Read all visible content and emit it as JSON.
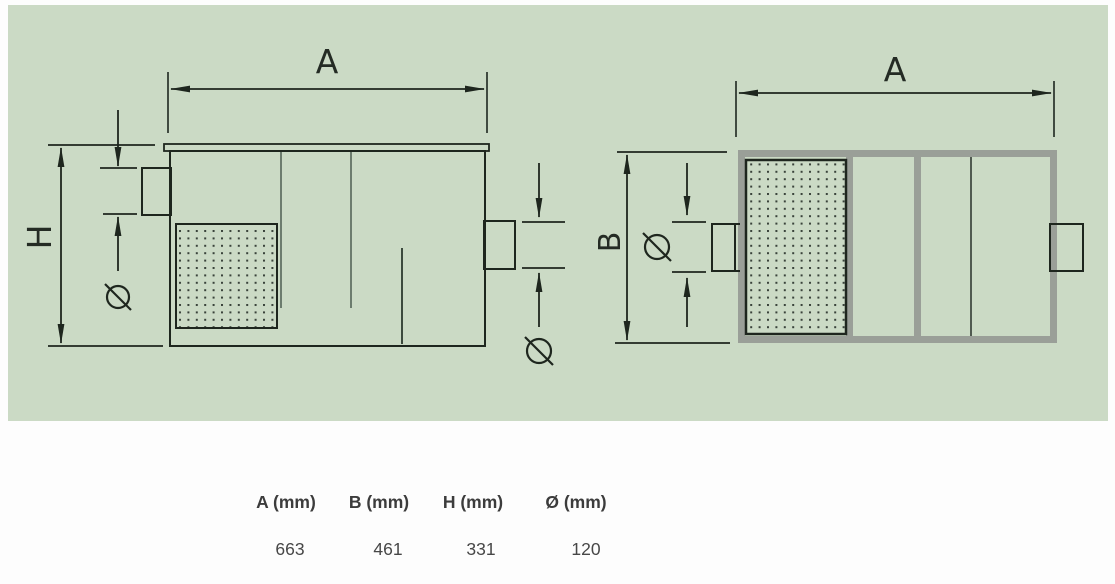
{
  "side_view": {
    "width_label": "A",
    "height_label": "H",
    "inlet_diameter_symbol": "Ø",
    "outlet_diameter_symbol": "Ø"
  },
  "top_view": {
    "width_label": "A",
    "depth_label": "B",
    "inlet_diameter_symbol": "Ø"
  },
  "dimensions_table": {
    "columns": [
      "A (mm)",
      "B (mm)",
      "H (mm)",
      "Ø (mm)"
    ],
    "values": [
      "663",
      "461",
      "331",
      "120"
    ]
  },
  "colors": {
    "panel_green": "#cbdac5",
    "line_black": "#1e261e",
    "frame_gray": "#9a9f98",
    "baffle_gray": "#6c7c6e",
    "dot_dark": "#39423a"
  }
}
